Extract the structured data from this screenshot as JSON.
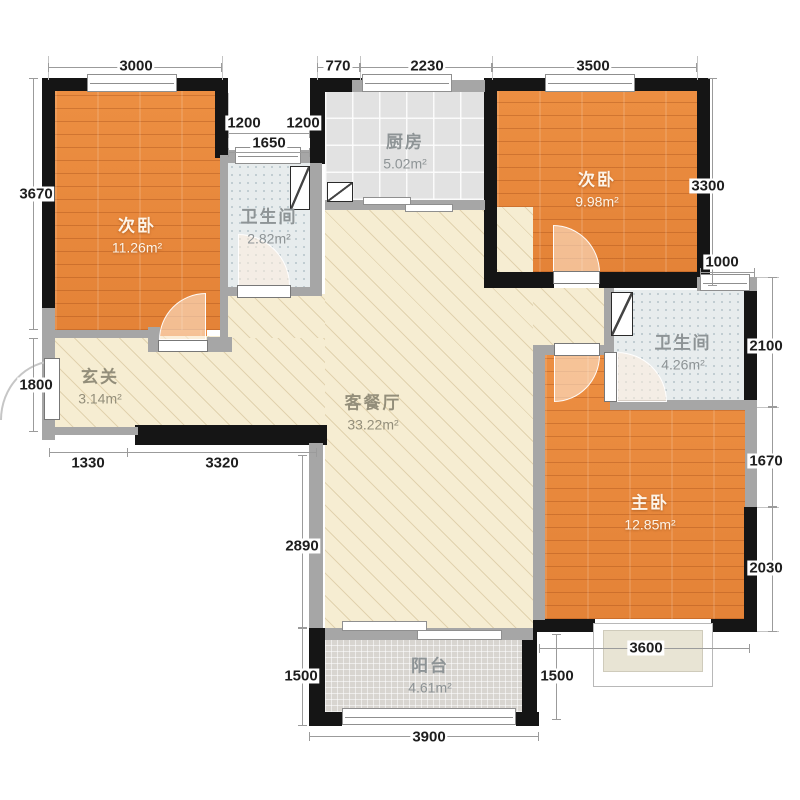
{
  "rooms": {
    "bedroom1": {
      "name": "次卧",
      "area": "11.26m²"
    },
    "bathroom1": {
      "name": "卫生间",
      "area": "2.82m²"
    },
    "kitchen": {
      "name": "厨房",
      "area": "5.02m²"
    },
    "bedroom2": {
      "name": "次卧",
      "area": "9.98m²"
    },
    "bathroom2": {
      "name": "卫生间",
      "area": "4.26m²"
    },
    "entry": {
      "name": "玄关",
      "area": "3.14m²"
    },
    "living": {
      "name": "客餐厅",
      "area": "33.22m²"
    },
    "master": {
      "name": "主卧",
      "area": "12.85m²"
    },
    "balcony": {
      "name": "阳台",
      "area": "4.61m²"
    }
  },
  "dimensions": {
    "top_3000": "3000",
    "top_770": "770",
    "top_2230": "2230",
    "top_3500": "3500",
    "notch_1200_left": "1200",
    "notch_1200_right": "1200",
    "notch_1650": "1650",
    "left_3670": "3670",
    "left_1800": "1800",
    "right_3300": "3300",
    "right_1000": "1000",
    "right_2100": "2100",
    "right_1670": "1670",
    "right_2030": "2030",
    "bottom_1330": "1330",
    "bottom_3320": "3320",
    "mid_2890": "2890",
    "bottom_1500_left": "1500",
    "bottom_1500_right": "1500",
    "bottom_3900": "3900",
    "bottom_3600": "3600"
  },
  "colors": {
    "wall_black": "#151515",
    "wall_gray": "#a6a6a6",
    "wood_floor": "#e8883c",
    "living_floor": "#f6edd2",
    "kitchen_tile": "#e2e2e2",
    "bath_tile": "#e7eced",
    "balcony_tile": "#d8d5d0"
  }
}
